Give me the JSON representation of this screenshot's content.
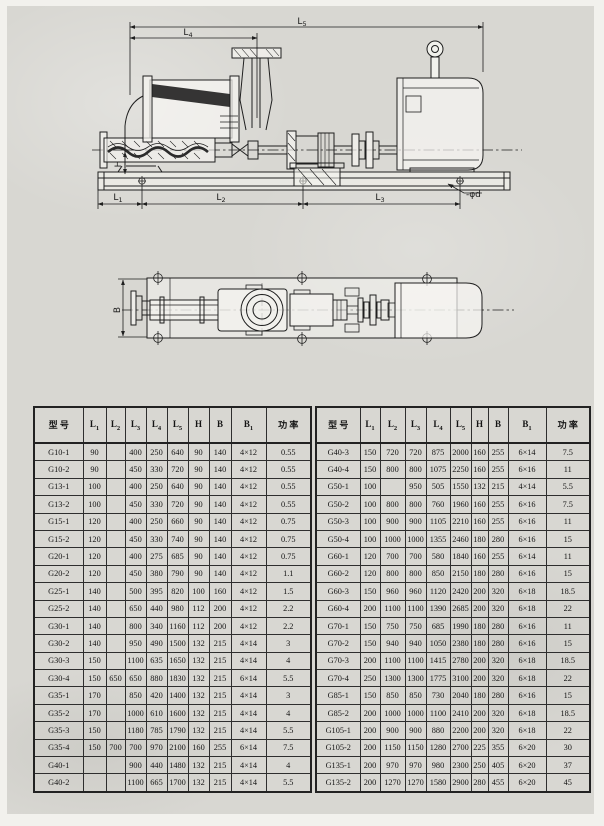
{
  "page": {
    "background": "#d8d7d2",
    "ink": "#1f1f1f"
  },
  "side_view": {
    "labels": {
      "l5": {
        "base": "L",
        "sub": "5"
      },
      "l4": {
        "base": "L",
        "sub": "4"
      },
      "l1": {
        "base": "L",
        "sub": "1"
      },
      "l2": {
        "base": "L",
        "sub": "2"
      },
      "l3": {
        "base": "L",
        "sub": "3"
      },
      "h": {
        "base": "H",
        "sub": ""
      },
      "phi_d": "-φd"
    }
  },
  "top_view": {
    "labels": {
      "b": {
        "base": "B",
        "sub": ""
      }
    }
  },
  "tables": {
    "headers": [
      {
        "base": "型 号",
        "sub": ""
      },
      {
        "base": "L",
        "sub": "1"
      },
      {
        "base": "L",
        "sub": "2"
      },
      {
        "base": "L",
        "sub": "3"
      },
      {
        "base": "L",
        "sub": "4"
      },
      {
        "base": "L",
        "sub": "5"
      },
      {
        "base": "H",
        "sub": ""
      },
      {
        "base": "B",
        "sub": ""
      },
      {
        "base": "B",
        "sub": "1"
      },
      {
        "base": "功 率",
        "sub": ""
      }
    ],
    "left_rows": [
      [
        "G10-1",
        "90",
        "",
        "400",
        "250",
        "640",
        "90",
        "140",
        "4×12",
        "0.55"
      ],
      [
        "G10-2",
        "90",
        "",
        "450",
        "330",
        "720",
        "90",
        "140",
        "4×12",
        "0.55"
      ],
      [
        "G13-1",
        "100",
        "",
        "400",
        "250",
        "640",
        "90",
        "140",
        "4×12",
        "0.55"
      ],
      [
        "G13-2",
        "100",
        "",
        "450",
        "330",
        "720",
        "90",
        "140",
        "4×12",
        "0.55"
      ],
      [
        "G15-1",
        "120",
        "",
        "400",
        "250",
        "660",
        "90",
        "140",
        "4×12",
        "0.75"
      ],
      [
        "G15-2",
        "120",
        "",
        "450",
        "330",
        "740",
        "90",
        "140",
        "4×12",
        "0.75"
      ],
      [
        "G20-1",
        "120",
        "",
        "400",
        "275",
        "685",
        "90",
        "140",
        "4×12",
        "0.75"
      ],
      [
        "G20-2",
        "120",
        "",
        "450",
        "380",
        "790",
        "90",
        "140",
        "4×12",
        "1.1"
      ],
      [
        "G25-1",
        "140",
        "",
        "500",
        "395",
        "820",
        "100",
        "160",
        "4×12",
        "1.5"
      ],
      [
        "G25-2",
        "140",
        "",
        "650",
        "440",
        "980",
        "112",
        "200",
        "4×12",
        "2.2"
      ],
      [
        "G30-1",
        "140",
        "",
        "800",
        "340",
        "1160",
        "112",
        "200",
        "4×12",
        "2.2"
      ],
      [
        "G30-2",
        "140",
        "",
        "950",
        "490",
        "1500",
        "132",
        "215",
        "4×14",
        "3"
      ],
      [
        "G30-3",
        "150",
        "",
        "1100",
        "635",
        "1650",
        "132",
        "215",
        "4×14",
        "4"
      ],
      [
        "G30-4",
        "150",
        "650",
        "650",
        "880",
        "1830",
        "132",
        "215",
        "6×14",
        "5.5"
      ],
      [
        "G35-1",
        "170",
        "",
        "850",
        "420",
        "1400",
        "132",
        "215",
        "4×14",
        "3"
      ],
      [
        "G35-2",
        "170",
        "",
        "1000",
        "610",
        "1600",
        "132",
        "215",
        "4×14",
        "4"
      ],
      [
        "G35-3",
        "150",
        "",
        "1180",
        "785",
        "1790",
        "132",
        "215",
        "4×14",
        "5.5"
      ],
      [
        "G35-4",
        "150",
        "700",
        "700",
        "970",
        "2100",
        "160",
        "255",
        "6×14",
        "7.5"
      ],
      [
        "G40-1",
        "",
        "",
        "900",
        "440",
        "1480",
        "132",
        "215",
        "4×14",
        "4"
      ],
      [
        "G40-2",
        "",
        "",
        "1100",
        "665",
        "1700",
        "132",
        "215",
        "4×14",
        "5.5"
      ]
    ],
    "right_rows": [
      [
        "G40-3",
        "150",
        "720",
        "720",
        "875",
        "2000",
        "160",
        "255",
        "6×14",
        "7.5"
      ],
      [
        "G40-4",
        "150",
        "800",
        "800",
        "1075",
        "2250",
        "160",
        "255",
        "6×16",
        "11"
      ],
      [
        "G50-1",
        "100",
        "",
        "950",
        "505",
        "1550",
        "132",
        "215",
        "4×14",
        "5.5"
      ],
      [
        "G50-2",
        "100",
        "800",
        "800",
        "760",
        "1960",
        "160",
        "255",
        "6×16",
        "7.5"
      ],
      [
        "G50-3",
        "100",
        "900",
        "900",
        "1105",
        "2210",
        "160",
        "255",
        "6×16",
        "11"
      ],
      [
        "G50-4",
        "100",
        "1000",
        "1000",
        "1355",
        "2460",
        "180",
        "280",
        "6×16",
        "15"
      ],
      [
        "G60-1",
        "120",
        "700",
        "700",
        "580",
        "1840",
        "160",
        "255",
        "6×14",
        "11"
      ],
      [
        "G60-2",
        "120",
        "800",
        "800",
        "850",
        "2150",
        "180",
        "280",
        "6×16",
        "15"
      ],
      [
        "G60-3",
        "150",
        "960",
        "960",
        "1120",
        "2420",
        "200",
        "320",
        "6×18",
        "18.5"
      ],
      [
        "G60-4",
        "200",
        "1100",
        "1100",
        "1390",
        "2685",
        "200",
        "320",
        "6×18",
        "22"
      ],
      [
        "G70-1",
        "150",
        "750",
        "750",
        "685",
        "1990",
        "180",
        "280",
        "6×16",
        "11"
      ],
      [
        "G70-2",
        "150",
        "940",
        "940",
        "1050",
        "2380",
        "180",
        "280",
        "6×16",
        "15"
      ],
      [
        "G70-3",
        "200",
        "1100",
        "1100",
        "1415",
        "2780",
        "200",
        "320",
        "6×18",
        "18.5"
      ],
      [
        "G70-4",
        "250",
        "1300",
        "1300",
        "1775",
        "3100",
        "200",
        "320",
        "6×18",
        "22"
      ],
      [
        "G85-1",
        "150",
        "850",
        "850",
        "730",
        "2040",
        "180",
        "280",
        "6×16",
        "15"
      ],
      [
        "G85-2",
        "200",
        "1000",
        "1000",
        "1100",
        "2410",
        "200",
        "320",
        "6×18",
        "18.5"
      ],
      [
        "G105-1",
        "200",
        "900",
        "900",
        "880",
        "2200",
        "200",
        "320",
        "6×18",
        "22"
      ],
      [
        "G105-2",
        "200",
        "1150",
        "1150",
        "1280",
        "2700",
        "225",
        "355",
        "6×20",
        "30"
      ],
      [
        "G135-1",
        "200",
        "970",
        "970",
        "980",
        "2300",
        "250",
        "405",
        "6×20",
        "37"
      ],
      [
        "G135-2",
        "200",
        "1270",
        "1270",
        "1580",
        "2900",
        "280",
        "455",
        "6×20",
        "45"
      ]
    ]
  }
}
